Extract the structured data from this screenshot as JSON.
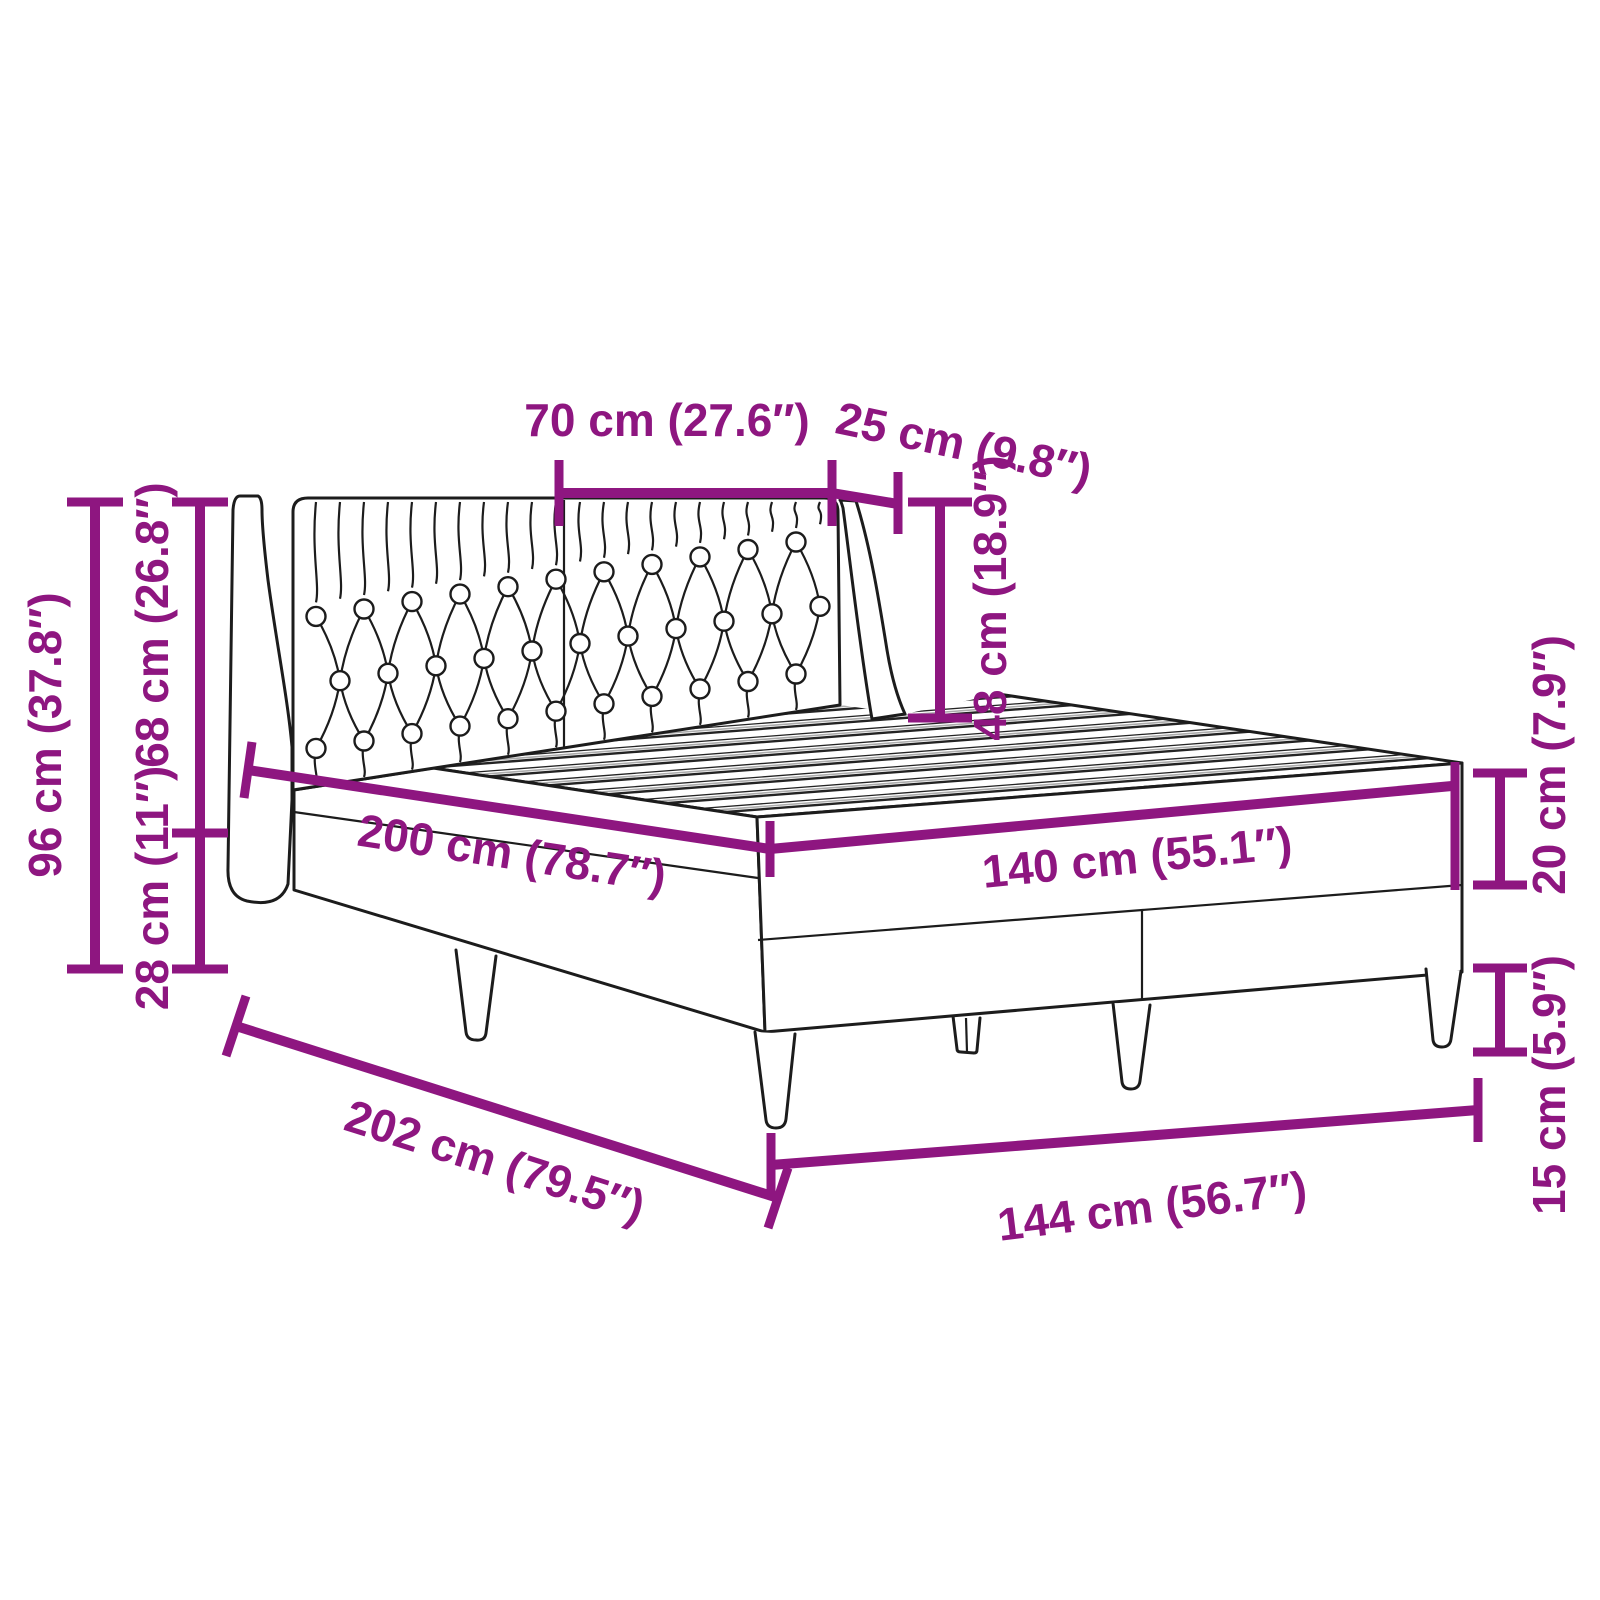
{
  "diagram": {
    "subject": "Bed frame with tufted wing headboard, slatted top and tapered legs",
    "accent_color": "#8e1680",
    "line_color": "#1c1c1c",
    "background_color": "#ffffff",
    "units": "cm (inches)",
    "dimensions": [
      {
        "id": "headboard-panel-width",
        "label": "70 cm (27.6″)"
      },
      {
        "id": "headboard-wing-depth",
        "label": "25 cm (9.8″)"
      },
      {
        "id": "headboard-above-slats",
        "label": "48 cm (18.9″)"
      },
      {
        "id": "total-height",
        "label": "96 cm (37.8″)"
      },
      {
        "id": "headboard-height",
        "label": "68 cm (26.8″)"
      },
      {
        "id": "base-rear-height",
        "label": "28 cm (11″)"
      },
      {
        "id": "bed-length",
        "label": "200 cm (78.7″)"
      },
      {
        "id": "bed-width",
        "label": "140 cm (55.1″)"
      },
      {
        "id": "frame-side-height",
        "label": "20 cm (7.9″)"
      },
      {
        "id": "leg-height",
        "label": "15 cm (5.9″)"
      },
      {
        "id": "total-length",
        "label": "202 cm (79.5″)"
      },
      {
        "id": "total-width",
        "label": "144 cm (56.7″)"
      }
    ]
  }
}
